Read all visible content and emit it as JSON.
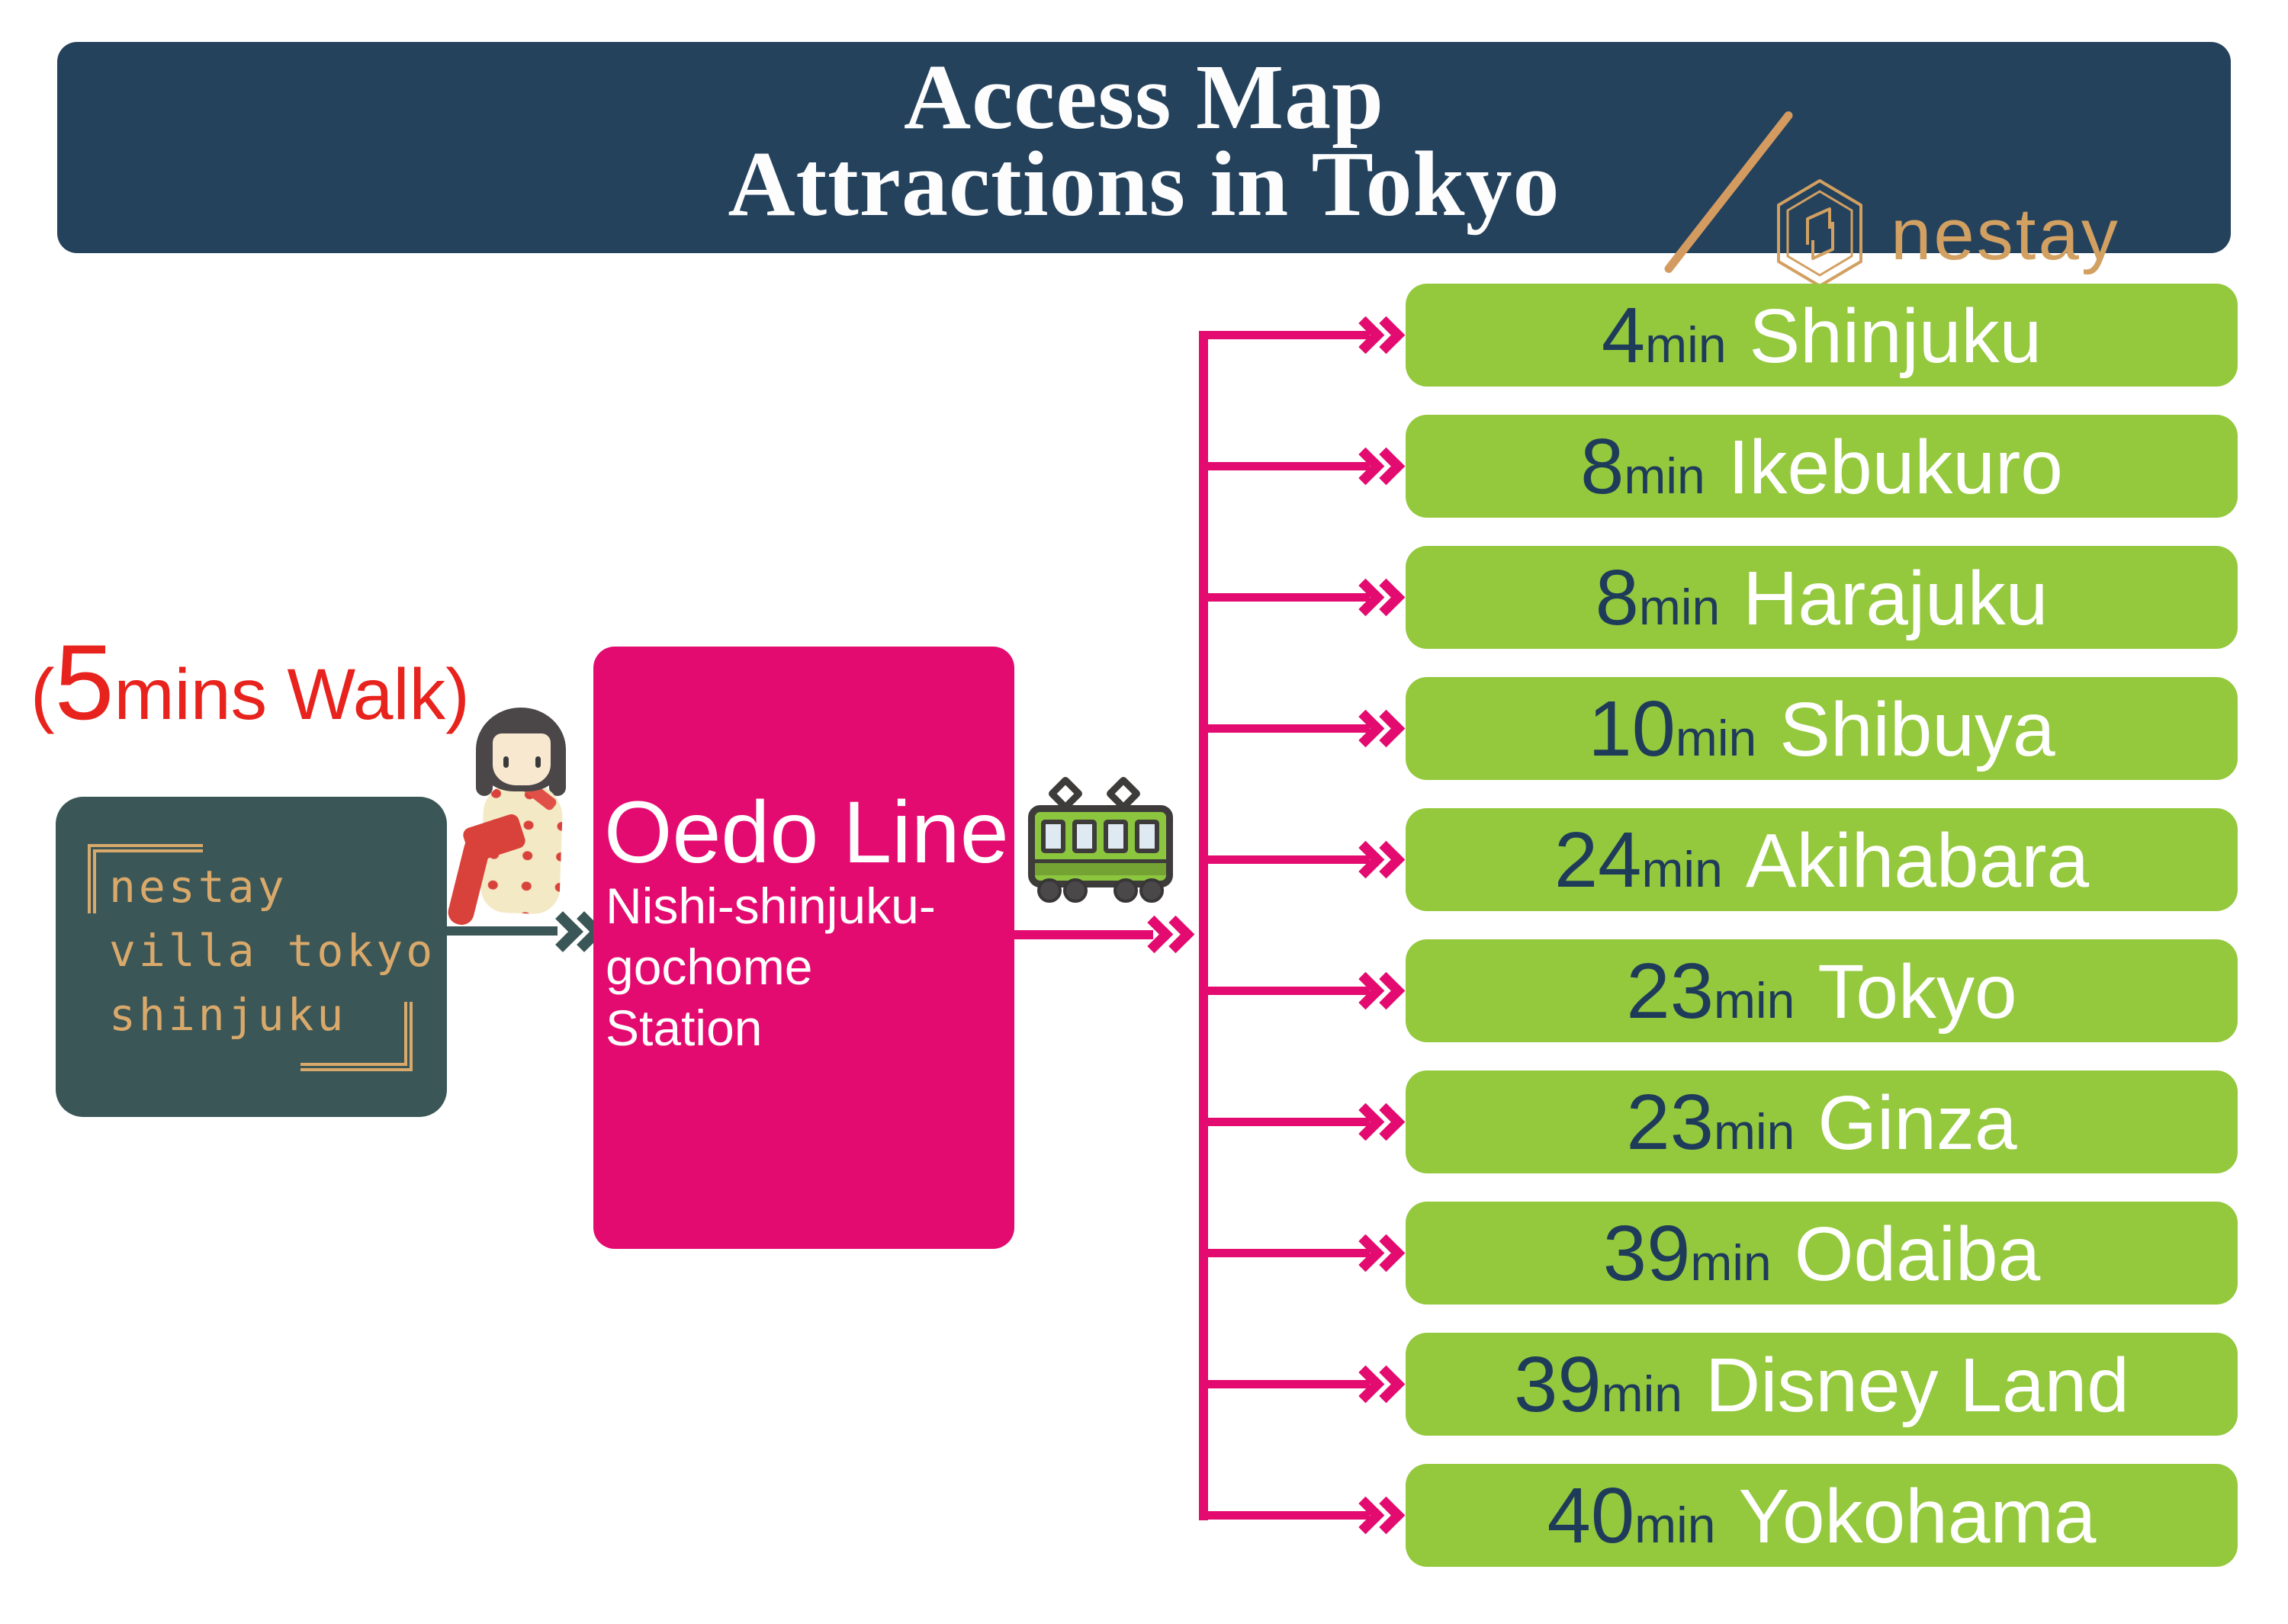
{
  "colors": {
    "header_bg": "#25425d",
    "accent_gold": "#d49b61",
    "walk_red": "#e8221c",
    "origin_bg": "#3b5656",
    "origin_text_gold": "#d9a96b",
    "station_pink": "#e30b6f",
    "bar_green": "#94c83d",
    "bar_navy": "#1e3c5a"
  },
  "header": {
    "title_line1": "Access Map",
    "title_line2": "Attractions in Tokyo",
    "brand": "nestay"
  },
  "walk_note": {
    "open": "(",
    "number": "5",
    "rest": "mins Walk)"
  },
  "origin_box": {
    "line1": "nestay",
    "line2": "villa tokyo",
    "line3": "shinjuku"
  },
  "station_box": {
    "line_name": "Oedo Line",
    "station_line1": "Nishi-shinjuku-",
    "station_line2": "gochome",
    "station_line3": "Station"
  },
  "destinations": [
    {
      "time": "4",
      "unit": "min",
      "name": "Shinjuku"
    },
    {
      "time": "8",
      "unit": "min",
      "name": "Ikebukuro"
    },
    {
      "time": "8",
      "unit": "min",
      "name": "Harajuku"
    },
    {
      "time": "10",
      "unit": "min",
      "name": "Shibuya"
    },
    {
      "time": "24",
      "unit": "min",
      "name": "Akihabara"
    },
    {
      "time": "23",
      "unit": "min",
      "name": "Tokyo"
    },
    {
      "time": "23",
      "unit": "min",
      "name": "Ginza"
    },
    {
      "time": "39",
      "unit": "min",
      "name": "Odaiba"
    },
    {
      "time": "39",
      "unit": "min",
      "name": "Disney Land"
    },
    {
      "time": "40",
      "unit": "min",
      "name": "Yokohama"
    }
  ]
}
